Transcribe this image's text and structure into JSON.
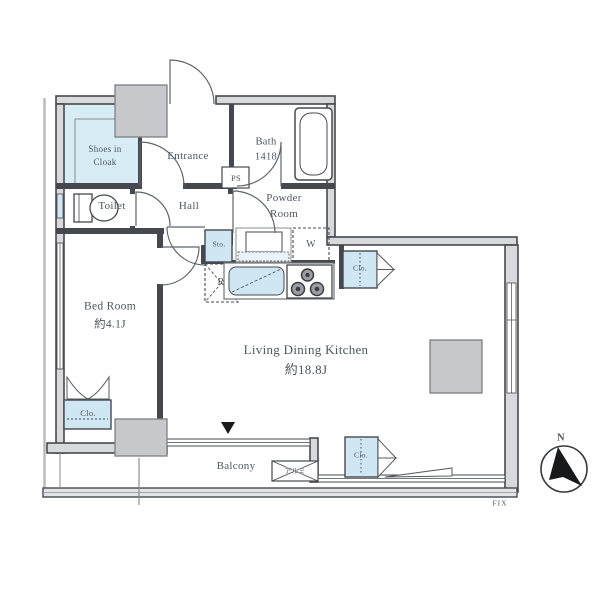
{
  "rooms": {
    "shoes_in_cloak": {
      "label": "Shoes in Cloak"
    },
    "entrance": {
      "label": "Entrance"
    },
    "bath": {
      "name": "Bath",
      "size": "1418"
    },
    "powder_room": {
      "label": "Powder Room"
    },
    "toilet": {
      "label": "Toilet"
    },
    "hall": {
      "label": "Hall"
    },
    "bed_room": {
      "name": "Bed Room",
      "size": "約4.1J"
    },
    "living_dining_kitchen": {
      "name": "Living Dining Kitchen",
      "size": "約18.8J"
    },
    "balcony": {
      "label": "Balcony"
    }
  },
  "fixtures": {
    "pipe_space": "PS",
    "storage": "Sto.",
    "washing_machine": "W",
    "refrigerator": "R",
    "closet_kitchen": "Clo.",
    "closet_bedroom": "Clo.",
    "closet_living": "Clo.",
    "aluminum_partition": "アルミ",
    "fixed_window": "FIX"
  },
  "compass": {
    "north": "N"
  },
  "colors": {
    "wall": "#45494f",
    "highlight_blue": "#cfe7f2",
    "pillar_gray": "#c7c8c9",
    "text": "#4e5760"
  }
}
